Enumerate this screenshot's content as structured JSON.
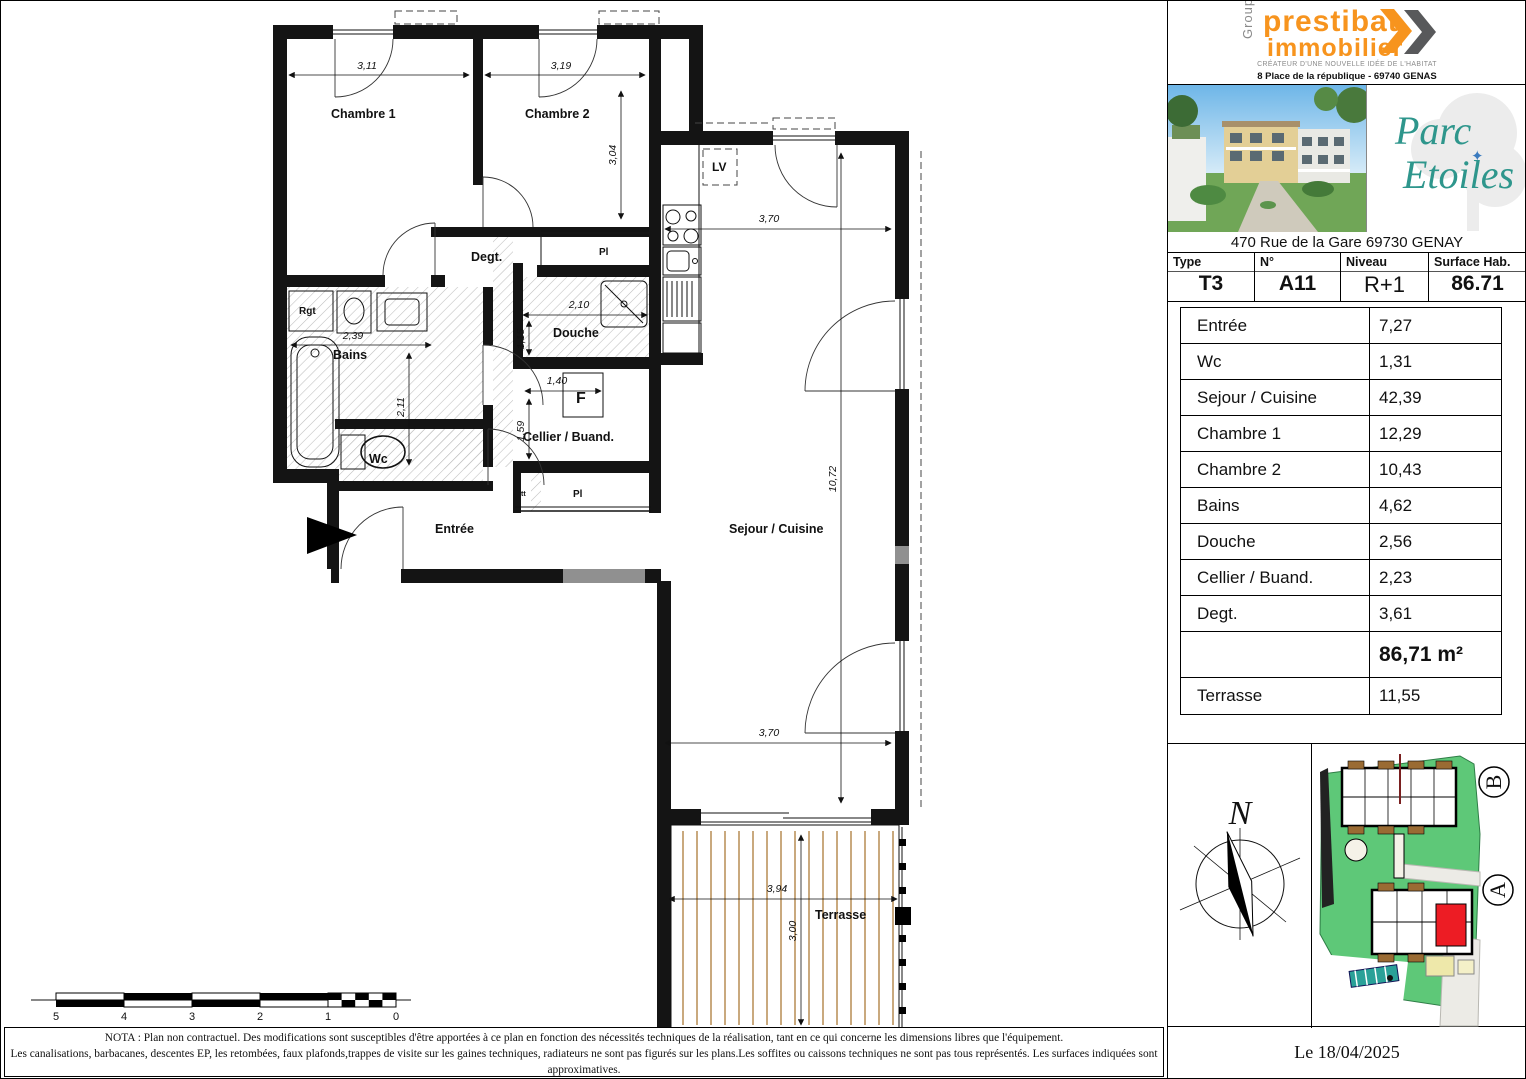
{
  "brand": {
    "groupe": "Groupe",
    "name1": "prestibat",
    "name2": "immobilier",
    "tagline": "CRÉATEUR D'UNE NOUVELLE IDÉE DE L'HABITAT",
    "address": "8 Place de la république - 69740 GENAS",
    "orange": "#F7941E",
    "gray": "#6D6E71"
  },
  "project": {
    "name1": "Parc",
    "name2": "Etoiles",
    "star": "✦",
    "teal": "#2E968C",
    "address": "470 Rue de la Gare 69730 GENAY"
  },
  "unit": {
    "headers": [
      "Type",
      "N°",
      "Niveau",
      "Surface Hab."
    ],
    "type": "T3",
    "number": "A11",
    "level": "R+1",
    "surface": "86.71"
  },
  "rooms": [
    {
      "label": "Entrée",
      "area": "7,27"
    },
    {
      "label": "Wc",
      "area": "1,31"
    },
    {
      "label": "Sejour / Cuisine",
      "area": "42,39"
    },
    {
      "label": "Chambre 1",
      "area": "12,29"
    },
    {
      "label": "Chambre 2",
      "area": "10,43"
    },
    {
      "label": "Bains",
      "area": "4,62"
    },
    {
      "label": "Douche",
      "area": "2,56"
    },
    {
      "label": "Cellier / Buand.",
      "area": "2,23"
    },
    {
      "label": "Degt.",
      "area": "3,61"
    }
  ],
  "total": {
    "label": "",
    "area": "86,71 m²"
  },
  "terrace_row": {
    "label": "Terrasse",
    "area": "11,55"
  },
  "plan": {
    "labels": {
      "chambre1": "Chambre 1",
      "chambre2": "Chambre 2",
      "degt": "Degt.",
      "bains": "Bains",
      "douche": "Douche",
      "wc": "Wc",
      "cellier": "Cellier / Buand.",
      "entree": "Entrée",
      "sejour": "Sejour / Cuisine",
      "terrasse": "Terrasse",
      "rgt": "Rgt",
      "lv": "LV",
      "pl1": "Pl",
      "pl2": "Pl",
      "tt": "tt",
      "f": "F"
    },
    "dims": {
      "ch1_w": "3,11",
      "ch2_w": "3,19",
      "ch2_h": "3,04",
      "kitchen_w": "3,70",
      "sejour_h": "10,72",
      "sejour_w": "3,70",
      "bains_w": "2,39",
      "bains_h": "2,11",
      "douche_w": "2,10",
      "douche_h": "1,15",
      "cellier_w": "1,40",
      "cellier_h": "1,59",
      "terrace_w": "3,94",
      "terrace_h": "3,00"
    },
    "scale": [
      "5",
      "4",
      "3",
      "2",
      "1",
      "0"
    ]
  },
  "site": {
    "north": "N",
    "building_a": "A",
    "building_b": "B",
    "green": "#5EC878",
    "highlight": "#ED1C24"
  },
  "footer": {
    "date": "Le 18/04/2025",
    "nota_line1": "NOTA :    Plan non contractuel. Des modifications sont susceptibles d'être apportées à ce plan en fonction des nécessités techniques de la réalisation, tant en ce qui concerne les dimensions libres que l'équipement.",
    "nota_line2": "Les canalisations, barbacanes, descentes EP, les retombées, faux plafonds,trappes de visite sur les gaines techniques, radiateurs ne sont pas figurés sur les plans.Les soffites ou caissons techniques ne sont pas tous représentés.  Les surfaces indiquées sont approximatives.",
    "nota_line3": "L'équipement éléctro ménager  n'est pas contractuel. Les dimensions de chaque pièce sont annoncées hors plinthes et revêtement muraux. Terrasse, le sens du platelage est donné à titre indicatif."
  }
}
